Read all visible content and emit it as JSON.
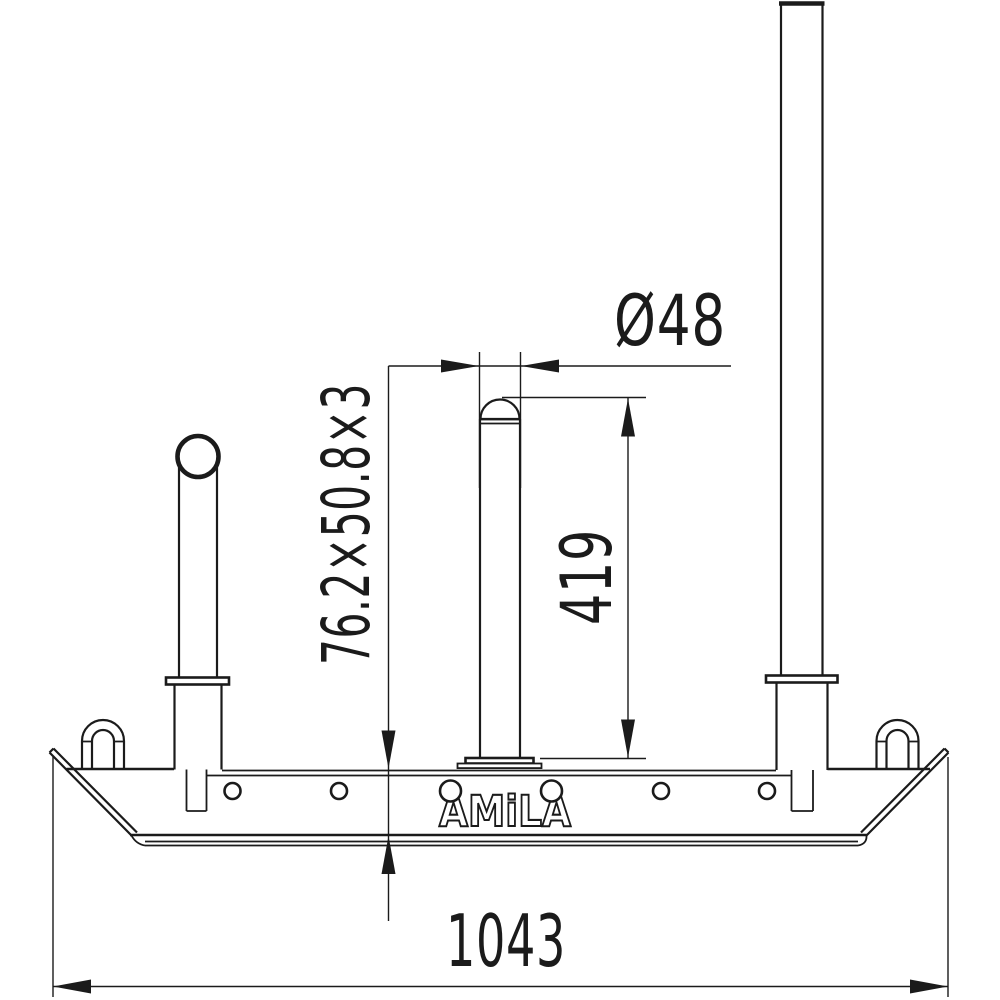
{
  "drawing": {
    "type": "technical-drawing-side-view",
    "brand_text": "AMiLA",
    "colors": {
      "line": "#1b1b1b",
      "background": "#ffffff"
    },
    "dimensions": {
      "post_diameter": "Ø48",
      "base_tube_profile": "76.2×50.8×3",
      "post_height": "419",
      "base_length": "1043"
    }
  }
}
